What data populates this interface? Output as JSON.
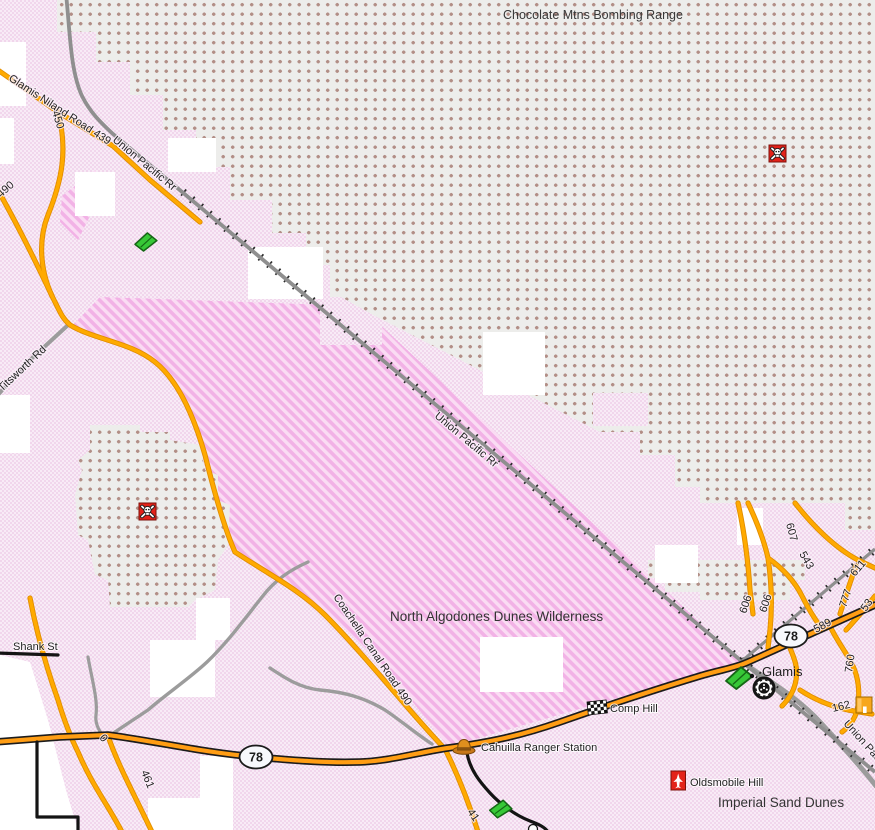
{
  "map_labels": {
    "bombing_range": "Chocolate Mtns Bombing Range",
    "wilderness": "North Algodones Dunes Wilderness",
    "imperial": "Imperial Sand Dunes",
    "glamis_town": "Glamis",
    "shank": "Shank St",
    "titsworth": "Titsworth Rd",
    "glamis_niland": "Glamis Niland Road 439",
    "union_pacific": "Union Pacific Rr",
    "coachella": "Coachella Canal Road 490"
  },
  "pois": {
    "comp_hill": "Comp Hill",
    "cahuilla": "Cahuilla Ranger Station",
    "oldsmobile": "Oldsmobile Hill"
  },
  "shields": {
    "highway_78": "78"
  },
  "road_numbers": {
    "n450": "450",
    "n490": "490",
    "n461": "461",
    "n41": "41",
    "n0": "0",
    "n607": "607",
    "n543": "543",
    "n606": "606",
    "n589": "589",
    "n611": "611",
    "n777": "777",
    "n53": "53",
    "n760": "760",
    "n162": "162"
  },
  "colors": {
    "base_pink": "#f5e1f1",
    "dune_magenta": "#f2b2e6",
    "range_dot_brown": "#b28e86",
    "road_orange": "#ffaa00",
    "highway_orange": "#ff9d14",
    "road_gray": "#9c9c9c",
    "rail_gray": "#8f8f8f",
    "danger_red": "#e3231a",
    "flag_green": "#37c837",
    "hat_brown": "#c87818"
  }
}
